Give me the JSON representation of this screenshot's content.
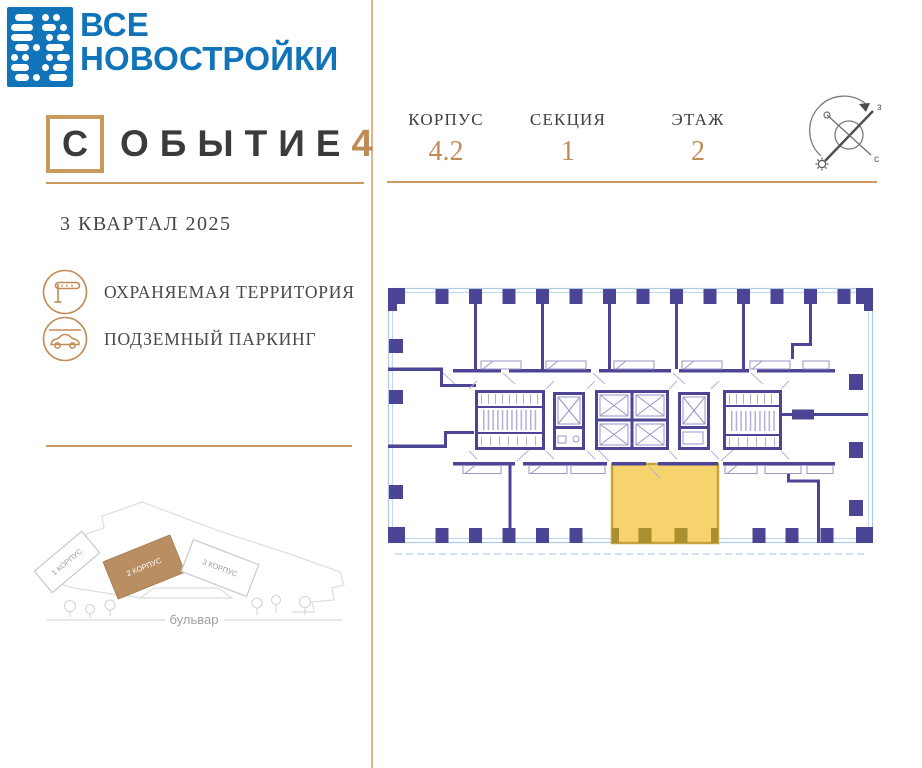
{
  "brand": {
    "line1": "ВСЕ",
    "line2": "НОВОСТРОЙКИ"
  },
  "project": {
    "boxed_letter": "С",
    "word_rest": "ОБЫТИЕ",
    "number": "4",
    "completion": "3 КВАРТАЛ 2025"
  },
  "amenities": [
    {
      "icon": "barrier-gate-icon",
      "label": "ОХРАНЯЕМАЯ ТЕРРИТОРИЯ"
    },
    {
      "icon": "car-parking-icon",
      "label": "ПОДЗЕМНЫЙ ПАРКИНГ"
    }
  ],
  "plan_header": {
    "fields": [
      {
        "label": "КОРПУС",
        "value": "4.2"
      },
      {
        "label": "СЕКЦИЯ",
        "value": "1"
      },
      {
        "label": "ЭТАЖ",
        "value": "2"
      }
    ]
  },
  "compass": {
    "label_ne": "з",
    "label_se": "с"
  },
  "site_map": {
    "buildings": [
      {
        "label": "1 КОРПУС",
        "highlighted": false
      },
      {
        "label": "2 КОРПУС",
        "highlighted": true
      },
      {
        "label": "3 КОРПУС",
        "highlighted": false
      }
    ],
    "highlighted_building": "2 КОРПУС",
    "street": "бульвар"
  },
  "colors": {
    "brand_blue": "#1173b8",
    "accent_gold": "#c08b55",
    "plan_purple": "#4c4596",
    "plan_glazing_blue": "#aecbe6",
    "highlight_yellow": "#f5d164",
    "highlight_border": "#c9a23c",
    "minimap_building_tan": "#b98e63"
  }
}
